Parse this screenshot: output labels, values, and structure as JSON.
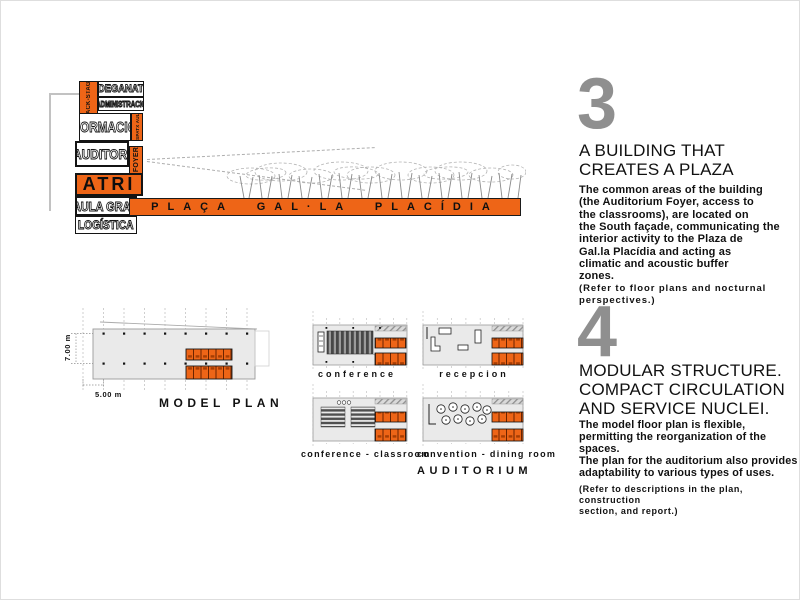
{
  "page": {
    "accent_orange": "#ee6517",
    "number_gray": "#8f8f8f"
  },
  "program_diagram": {
    "back_stage": "BACK-STAGE",
    "deganat": "DEGANAT",
    "administracio": "ADMINISTRACIÓ",
    "formacio": "FORMACIÓ",
    "despatx_aules": "DESPATX AULES",
    "auditori": "AUDITORI",
    "foyer": "FOYER",
    "atri": "ATRI",
    "aula_gran": "AULA GRAN",
    "logistica": "LOGÍSTICA"
  },
  "plaza_bar": {
    "label": "PLAÇA GAL·LA PLACÍDIA"
  },
  "section_3": {
    "number": "3",
    "heading": "A BUILDING THAT\nCREATES A PLAZA",
    "body": "The common areas of the building\n(the Auditorium Foyer, access to\nthe classrooms), are located on\nthe South façade, communicating the\ninterior activity to the Plaza de\nGal.la Placídia and acting as\nclimatic and acoustic buffer\nzones.",
    "note": "(Refer to floor plans and nocturnal\nperspectives.)"
  },
  "section_4": {
    "number": "4",
    "heading": "MODULAR STRUCTURE.\nCOMPACT CIRCULATION\nAND SERVICE NUCLEI.",
    "body": "The model floor plan is flexible,\npermitting the reorganization of the\nspaces.\nThe plan for the auditorium also provides\nadaptability to various types of uses.",
    "note": "(Refer to descriptions in the plan, construction\nsection, and report.)"
  },
  "model_plan": {
    "label": "MODEL PLAN",
    "dim_vertical": "7.00 m",
    "dim_horizontal": "5.00 m"
  },
  "plan_variants": {
    "conference": "conference",
    "recepcion": "recepcion",
    "conference_classroom": "conference - classroom",
    "convention_dining": "convention - dining room",
    "group_label": "AUDITORIUM"
  }
}
